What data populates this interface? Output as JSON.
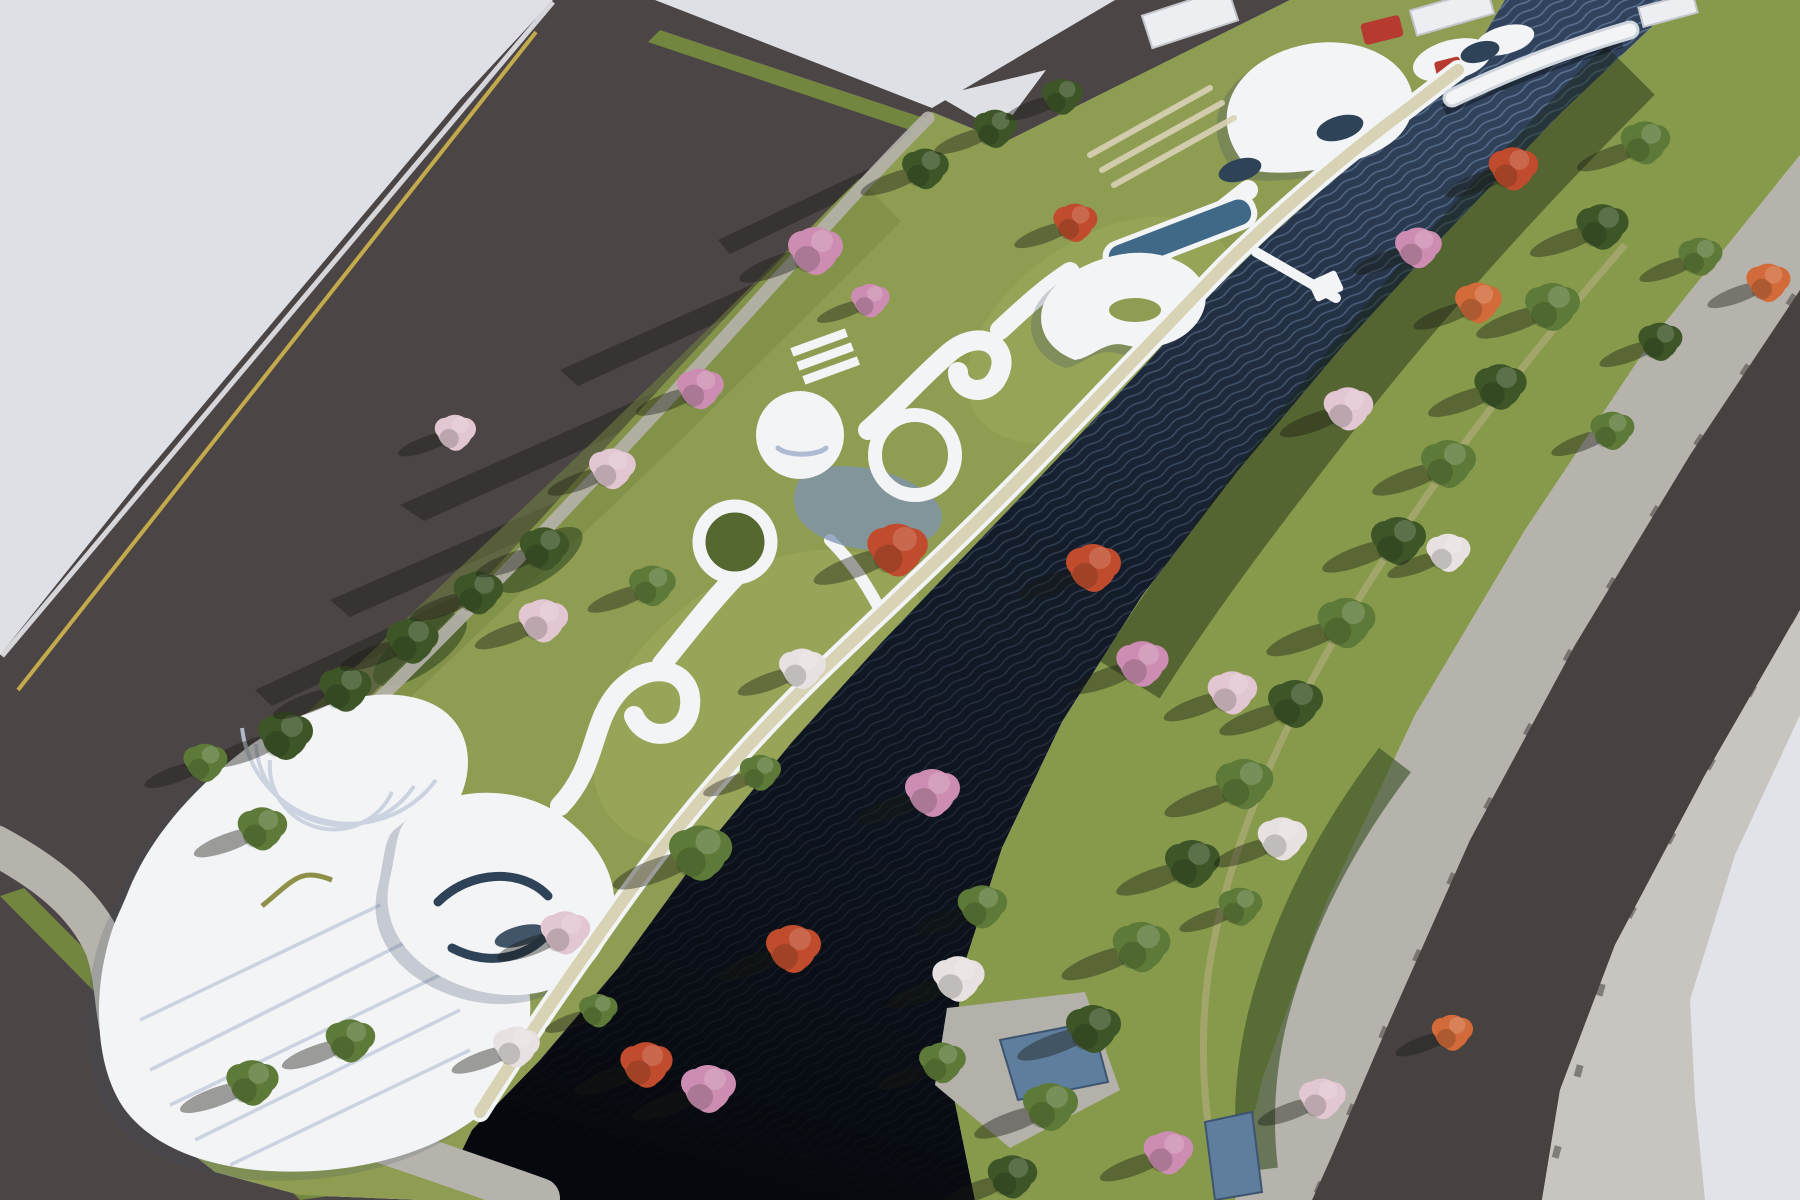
{
  "palette": {
    "bg": "#e2e3e9",
    "lot": "#dfe0e6",
    "road": "#4b4545",
    "roadNorth": "#474140",
    "sidewalk": "#b6b2ac",
    "sidewalk2": "#c8c5c0",
    "curb": "#d6d6da",
    "verge": "#72863f",
    "lawn": "#8e9d52",
    "lawnLight": "#a2ae5f",
    "lawnDark": "#75883f",
    "hedge": "#3f5429",
    "bank": "#879a4b",
    "waterTop": "#31435c",
    "waterMid": "#141d2b",
    "waterDeep": "#06080d",
    "wave": "#7b97bd",
    "pathCream": "#d9d3b6",
    "ribbonWhite": "#f3f4f6",
    "ribbonShade": "#aebbd2",
    "structShadow": "#3f4d66",
    "glassNavy": "#2f4358",
    "pool": "#3f6986",
    "yellowLine": "#c3aa4c",
    "accentRed": "#b73a30",
    "accentBlue": "#5f7d9c",
    "deckGray": "#b4b0aa",
    "treeGreen": "#5d7a38",
    "treeDark": "#3d5527",
    "treePink": "#cd8db2",
    "treePale": "#e2c6d2",
    "treeRed": "#c04c2d",
    "treeOrange": "#d26a3a",
    "treeWhite": "#e8e1e1",
    "shadow": "rgba(22,26,18,0.40)"
  },
  "scene": {
    "trees": [
      {
        "x": 285,
        "y": 735,
        "s": 1.0,
        "t": "darkgreen"
      },
      {
        "x": 345,
        "y": 688,
        "s": 0.95,
        "t": "darkgreen"
      },
      {
        "x": 412,
        "y": 640,
        "s": 0.95,
        "t": "darkgreen"
      },
      {
        "x": 478,
        "y": 592,
        "s": 0.9,
        "t": "darkgreen"
      },
      {
        "x": 544,
        "y": 548,
        "s": 0.9,
        "t": "darkgreen"
      },
      {
        "x": 205,
        "y": 762,
        "s": 0.8,
        "t": "green"
      },
      {
        "x": 262,
        "y": 828,
        "s": 0.9,
        "t": "green"
      },
      {
        "x": 252,
        "y": 1082,
        "s": 0.95,
        "t": "green"
      },
      {
        "x": 350,
        "y": 1040,
        "s": 0.9,
        "t": "green"
      },
      {
        "x": 700,
        "y": 852,
        "s": 1.15,
        "t": "green"
      },
      {
        "x": 760,
        "y": 772,
        "s": 0.75,
        "t": "green"
      },
      {
        "x": 652,
        "y": 585,
        "s": 0.85,
        "t": "green"
      },
      {
        "x": 925,
        "y": 168,
        "s": 0.85,
        "t": "darkgreen"
      },
      {
        "x": 995,
        "y": 128,
        "s": 0.8,
        "t": "darkgreen"
      },
      {
        "x": 1062,
        "y": 96,
        "s": 0.75,
        "t": "darkgreen"
      },
      {
        "x": 598,
        "y": 1010,
        "s": 0.7,
        "t": "green"
      },
      {
        "x": 815,
        "y": 250,
        "s": 1.0,
        "t": "pink"
      },
      {
        "x": 700,
        "y": 388,
        "s": 0.85,
        "t": "pink"
      },
      {
        "x": 612,
        "y": 468,
        "s": 0.85,
        "t": "palepink"
      },
      {
        "x": 543,
        "y": 620,
        "s": 0.9,
        "t": "palepink"
      },
      {
        "x": 455,
        "y": 432,
        "s": 0.75,
        "t": "palepink"
      },
      {
        "x": 565,
        "y": 932,
        "s": 0.9,
        "t": "palepink"
      },
      {
        "x": 516,
        "y": 1046,
        "s": 0.85,
        "t": "white"
      },
      {
        "x": 646,
        "y": 1064,
        "s": 0.95,
        "t": "red"
      },
      {
        "x": 897,
        "y": 549,
        "s": 1.1,
        "t": "red"
      },
      {
        "x": 802,
        "y": 668,
        "s": 0.85,
        "t": "white"
      },
      {
        "x": 870,
        "y": 300,
        "s": 0.7,
        "t": "pink"
      },
      {
        "x": 1075,
        "y": 222,
        "s": 0.8,
        "t": "red"
      },
      {
        "x": 1645,
        "y": 142,
        "s": 0.9,
        "t": "green"
      },
      {
        "x": 1602,
        "y": 226,
        "s": 0.95,
        "t": "darkgreen"
      },
      {
        "x": 1552,
        "y": 306,
        "s": 1.0,
        "t": "green"
      },
      {
        "x": 1500,
        "y": 386,
        "s": 0.95,
        "t": "darkgreen"
      },
      {
        "x": 1448,
        "y": 463,
        "s": 1.0,
        "t": "green"
      },
      {
        "x": 1398,
        "y": 540,
        "s": 1.0,
        "t": "darkgreen"
      },
      {
        "x": 1346,
        "y": 622,
        "s": 1.05,
        "t": "green"
      },
      {
        "x": 1295,
        "y": 703,
        "s": 1.0,
        "t": "darkgreen"
      },
      {
        "x": 1244,
        "y": 783,
        "s": 1.05,
        "t": "green"
      },
      {
        "x": 1192,
        "y": 863,
        "s": 1.0,
        "t": "darkgreen"
      },
      {
        "x": 1141,
        "y": 946,
        "s": 1.05,
        "t": "green"
      },
      {
        "x": 1093,
        "y": 1028,
        "s": 1.0,
        "t": "darkgreen"
      },
      {
        "x": 1050,
        "y": 1106,
        "s": 1.0,
        "t": "green"
      },
      {
        "x": 1012,
        "y": 1176,
        "s": 0.9,
        "t": "darkgreen"
      },
      {
        "x": 1700,
        "y": 256,
        "s": 0.8,
        "t": "green"
      },
      {
        "x": 1660,
        "y": 341,
        "s": 0.8,
        "t": "darkgreen"
      },
      {
        "x": 1612,
        "y": 430,
        "s": 0.8,
        "t": "green"
      },
      {
        "x": 982,
        "y": 906,
        "s": 0.9,
        "t": "green"
      },
      {
        "x": 1240,
        "y": 906,
        "s": 0.8,
        "t": "green"
      },
      {
        "x": 942,
        "y": 1062,
        "s": 0.85,
        "t": "green"
      },
      {
        "x": 1513,
        "y": 168,
        "s": 0.9,
        "t": "red"
      },
      {
        "x": 1478,
        "y": 302,
        "s": 0.85,
        "t": "orange"
      },
      {
        "x": 1418,
        "y": 247,
        "s": 0.85,
        "t": "pink"
      },
      {
        "x": 1348,
        "y": 408,
        "s": 0.9,
        "t": "palepink"
      },
      {
        "x": 1093,
        "y": 567,
        "s": 1.0,
        "t": "red"
      },
      {
        "x": 1142,
        "y": 663,
        "s": 0.95,
        "t": "pink"
      },
      {
        "x": 1232,
        "y": 692,
        "s": 0.9,
        "t": "palepink"
      },
      {
        "x": 932,
        "y": 792,
        "s": 1.0,
        "t": "pink"
      },
      {
        "x": 958,
        "y": 978,
        "s": 0.95,
        "t": "white"
      },
      {
        "x": 708,
        "y": 1088,
        "s": 1.0,
        "t": "pink"
      },
      {
        "x": 793,
        "y": 948,
        "s": 1.0,
        "t": "red"
      },
      {
        "x": 1168,
        "y": 1152,
        "s": 0.9,
        "t": "pink"
      },
      {
        "x": 1322,
        "y": 1098,
        "s": 0.85,
        "t": "palepink"
      },
      {
        "x": 1282,
        "y": 838,
        "s": 0.9,
        "t": "white"
      },
      {
        "x": 1768,
        "y": 282,
        "s": 0.8,
        "t": "orange"
      },
      {
        "x": 1452,
        "y": 1032,
        "s": 0.75,
        "t": "orange"
      },
      {
        "x": 1448,
        "y": 552,
        "s": 0.8,
        "t": "white"
      }
    ]
  }
}
